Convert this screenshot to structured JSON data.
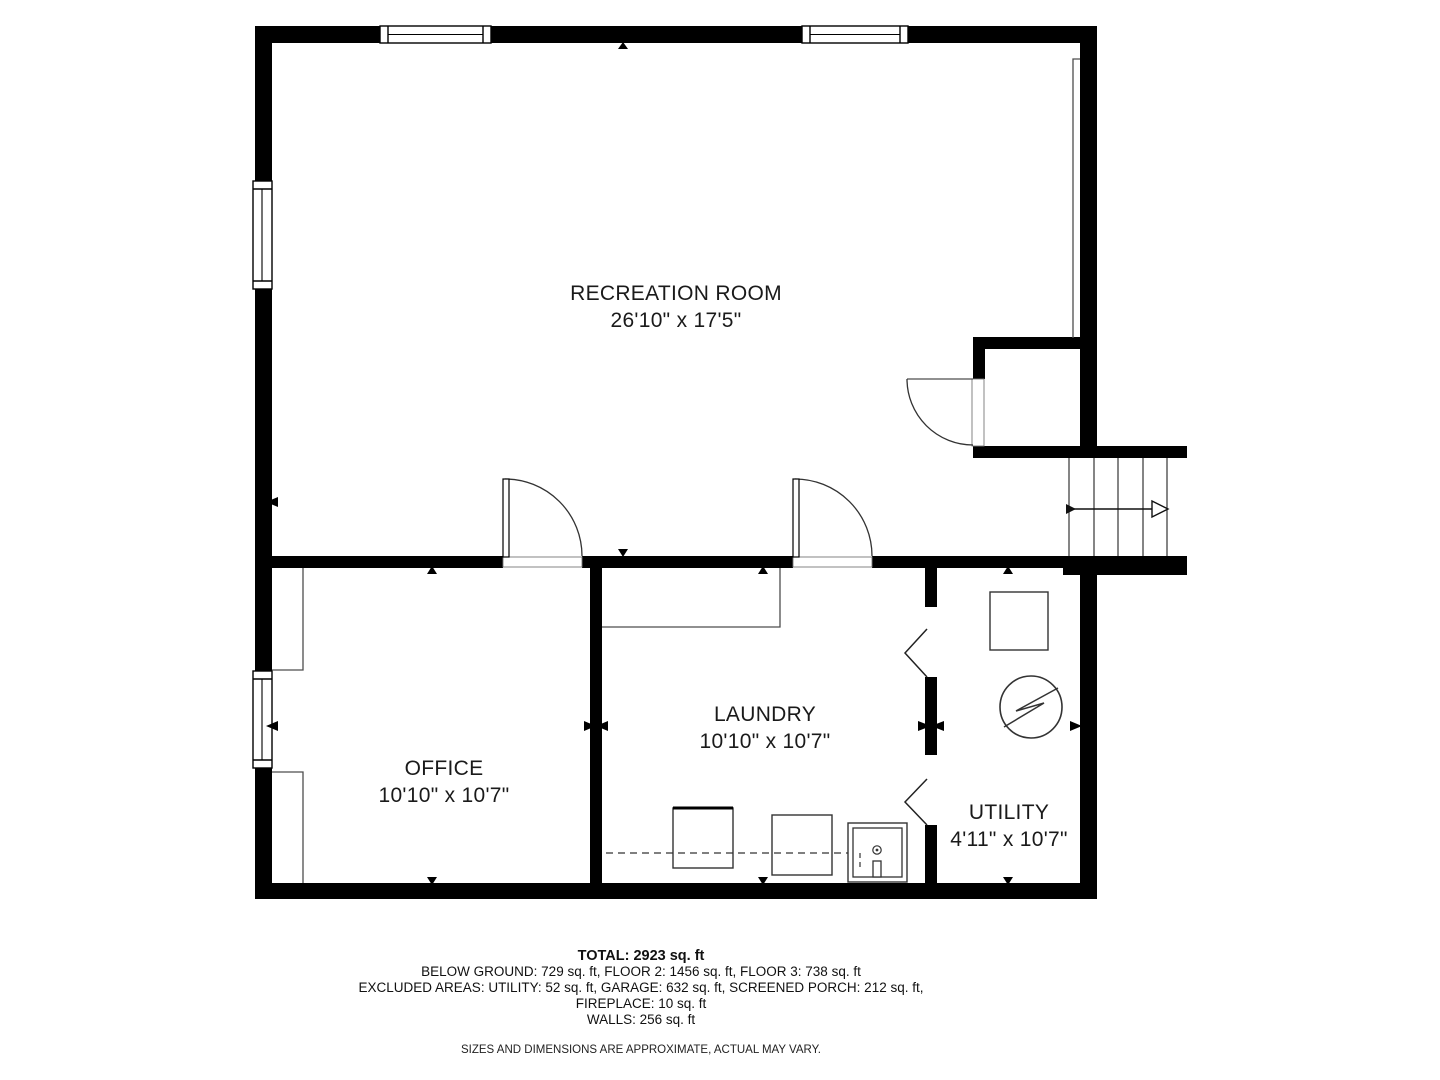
{
  "rooms": [
    {
      "name": "RECREATION ROOM",
      "dimensions": "26'10\" x 17'5\""
    },
    {
      "name": "OFFICE",
      "dimensions": "10'10\" x 10'7\""
    },
    {
      "name": "LAUNDRY",
      "dimensions": "10'10\" x 10'7\""
    },
    {
      "name": "UTILITY",
      "dimensions": "4'11\" x 10'7\""
    }
  ],
  "summary": {
    "total": "TOTAL: 2923 sq. ft",
    "floors": "BELOW GROUND: 729 sq. ft, FLOOR 2: 1456 sq. ft, FLOOR 3: 738 sq. ft",
    "excluded": "EXCLUDED AREAS: UTILITY: 52 sq. ft, GARAGE: 632 sq. ft, SCREENED PORCH: 212 sq. ft,",
    "fireplace": "FIREPLACE: 10 sq. ft",
    "walls": "WALLS: 256 sq. ft",
    "disclaimer": "SIZES AND DIMENSIONS ARE APPROXIMATE, ACTUAL MAY VARY."
  },
  "colors": {
    "wall": "#000000",
    "background": "#ffffff",
    "thin_line": "#4d4d4d",
    "text": "#1a1a1a"
  }
}
